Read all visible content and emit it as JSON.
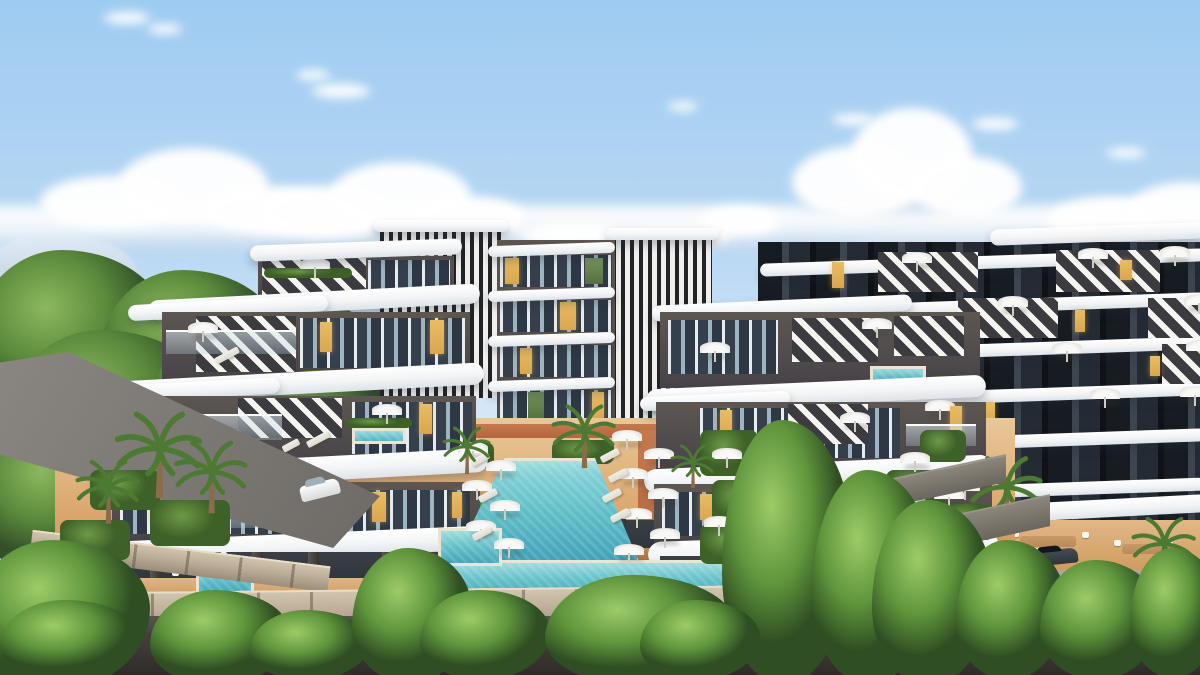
{
  "scene": {
    "type": "architectural-rendering",
    "setting": "aerial three-quarter view of a modern curvilinear residential apartment complex with a landscaped pool courtyard",
    "sky": "bright day, blue sky with a horizontal band of cumulus clouds and small high puffs",
    "objects": [
      "distant pale mountains at the horizon",
      "three apartment buildings with wavy white balcony slabs and dark taupe facades",
      "vertical black-and-white louver facade towers",
      "diagonal black-and-white striped facade panels",
      "warm amber lit windows",
      "long turquoise lap pool flaring toward an infinity edge",
      "horizontal infinity pool band along the terrace edge",
      "three small square plunge pools",
      "rooftop terrace spa pools with hedge planters",
      "rows of white sun umbrellas and sun loungers",
      "terracotta pool deck with red-brown garden paths",
      "hedge planters and garden shrubs",
      "palm trees in courtyard and at the left driveway",
      "stone block retaining wall above a dark asphalt road",
      "gray driveway with a white car",
      "dark sports car on the right access ramp",
      "outdoor dining tables with white chairs under the colonnades",
      "dense bright green trees across the foreground"
    ]
  },
  "palette": {
    "sky-top": "#9ecbf1",
    "sky-mid": "#cde2f6",
    "sky-low": "#e9f2fa",
    "cloud": "#ffffff",
    "cloud-sh": "#ccdcec",
    "mtn": "#c9d8e5",
    "bt1": "#33502a",
    "bt2": "#5b8a3c",
    "bt3": "#8db85f",
    "ft1": "#2f4e23",
    "ft2": "#5f953c",
    "ft3": "#9ecb67",
    "wall-a": "#474349",
    "wall-b": "#5d5651",
    "wall-c": "#2b3037",
    "slab": "#f2f4f6",
    "stripe": "#f5f4f0",
    "louv-d": "#232327",
    "louv-l": "#efefed",
    "glass-dark": "#36404c",
    "glass-light": "#9fb4c2",
    "lit": "#d9a64f",
    "pool1": "#8fd8da",
    "pool2": "#5cbcc6",
    "pool3": "#3f9fb6",
    "pool-edge": "#ece3d0",
    "deck": "#d9a269",
    "deck-light": "#e8c897",
    "path": "#b4653e",
    "hedge1": "#3e6128",
    "hedge2": "#6d9a47",
    "stone": "#bdaf99",
    "stone-joint": "#9a8d79",
    "road1": "#46413c",
    "road2": "#2f2b28",
    "drive": "#6e6a66",
    "pavement": "#938d82",
    "umb": "#f8f8f6",
    "lng": "#f1efe8",
    "carw": "#d8dadb",
    "card": "#2e353b",
    "wood": "#b98a5a",
    "trunk": "#8a6b4a",
    "frond": "#4d7a33"
  }
}
